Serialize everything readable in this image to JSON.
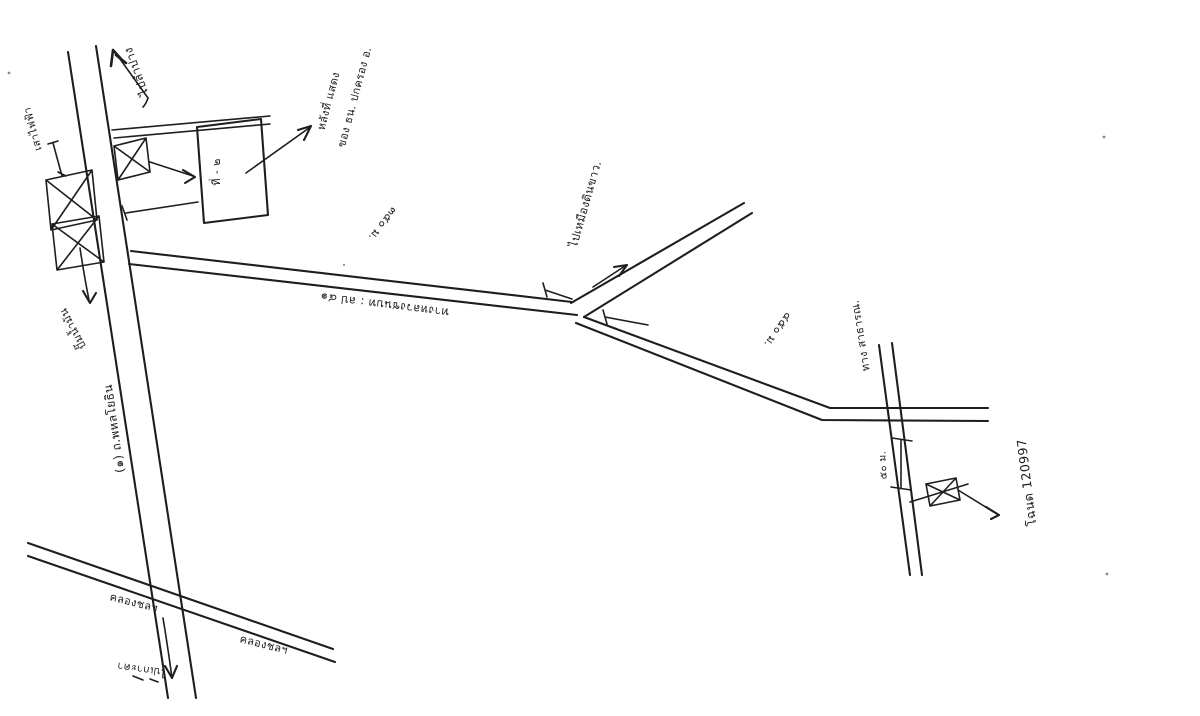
{
  "page": {
    "kind": "hand-drawn location sketch map (scanned)",
    "background": "#ffffff",
    "ink_color": "#1e1e1e"
  },
  "labels": {
    "to_lampang": "ไปลำปาง",
    "to_kokha": "ไปเกาะคา",
    "highway_name": "(๑) ถ.พหลโยธิน",
    "electric_pole": "เสาไฟฟ้า",
    "gas_station": "ปั๊มน้ำมัน",
    "building_text": "ที่ - ๒",
    "callout_line1": "หลังที่ แสดง",
    "callout_line2": "ของ ธน. ปกครอง อ.",
    "rural_road": "ทางหลวงชนบท : ลป ๔๑",
    "dist_350": "๓๕๐ ม.",
    "dist_450": "๔๕๐ ม.",
    "dist_50": "๕๐ ม.",
    "to_clay_mine": "ไปเหมืองดินขาว.",
    "public_way": "ทาง สาธารณ.",
    "deed_no": "โฉนด 120997",
    "canal_left": "คลองชลฯ",
    "canal_right": "คลองชลฯ"
  }
}
